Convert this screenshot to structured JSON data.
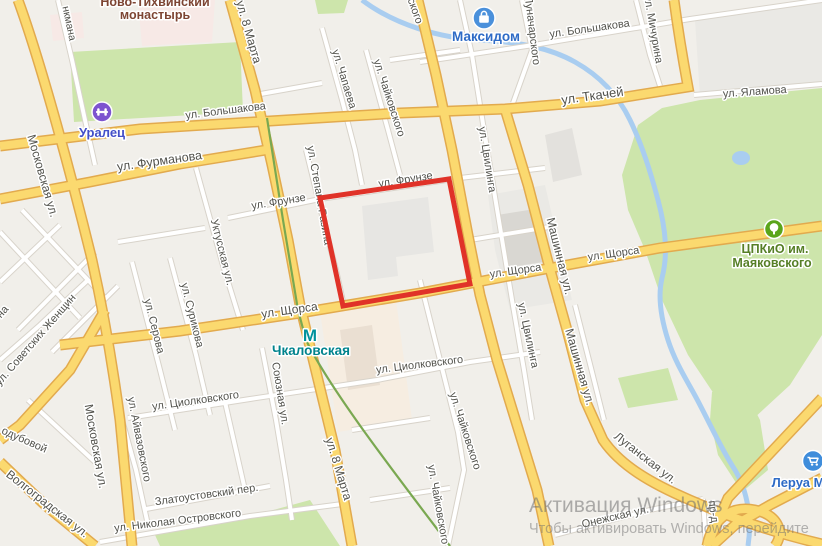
{
  "map": {
    "colors": {
      "land": "#f1efea",
      "green_area": "#cde5ab",
      "grey_area": "#eae9e5",
      "water": "#a9cdf0",
      "road_major_fill": "#fbd96f",
      "road_major_casing": "#e2aa4e",
      "road_minor_fill": "#ffffff",
      "road_minor_casing": "#d8d3ca",
      "tram_line": "#7aa851",
      "highlight_red": "#e03228",
      "street_text": "#52524c"
    },
    "street_labels": [
      {
        "t": "нкмана",
        "x": 66,
        "y": 24,
        "r": 78,
        "s": 10.5
      },
      {
        "t": "ул. 8 Марта",
        "x": 245,
        "y": 33,
        "r": 74,
        "s": 12
      },
      {
        "t": "ул. Большакова",
        "x": 226,
        "y": 114,
        "r": -7,
        "s": 11
      },
      {
        "t": "ул. Большакова",
        "x": 590,
        "y": 32,
        "r": -8,
        "s": 11
      },
      {
        "t": "ул. Мичурина",
        "x": 650,
        "y": 30,
        "r": 80,
        "s": 11
      },
      {
        "t": "ул. Ткачей",
        "x": 593,
        "y": 100,
        "r": -8,
        "s": 13
      },
      {
        "t": "ул. Яламова",
        "x": 755,
        "y": 95,
        "r": -4,
        "s": 11
      },
      {
        "t": "Луначарского",
        "x": 529,
        "y": 31,
        "r": 83,
        "s": 11
      },
      {
        "t": "ского",
        "x": 412,
        "y": 12,
        "r": 70,
        "s": 11
      },
      {
        "t": "ул. Чапаева",
        "x": 341,
        "y": 80,
        "r": 73,
        "s": 11
      },
      {
        "t": "ул. Чайковского",
        "x": 386,
        "y": 99,
        "r": 72,
        "s": 11
      },
      {
        "t": "ул. Фурманова",
        "x": 160,
        "y": 165,
        "r": -8,
        "s": 12.5
      },
      {
        "t": "Московская ул.",
        "x": 39,
        "y": 177,
        "r": 74,
        "s": 12
      },
      {
        "t": "Московская ул.",
        "x": 92,
        "y": 447,
        "r": 80,
        "s": 12
      },
      {
        "t": "ул. Фрунзе",
        "x": 279,
        "y": 205,
        "r": -9,
        "s": 11
      },
      {
        "t": "ул. Фрунзе",
        "x": 406,
        "y": 183,
        "r": -9,
        "s": 11
      },
      {
        "t": "ул. Степана Разина",
        "x": 316,
        "y": 196,
        "r": 80,
        "s": 11
      },
      {
        "t": "Уктусская ул.",
        "x": 219,
        "y": 253,
        "r": 76,
        "s": 11
      },
      {
        "t": "ул. Цвилинга",
        "x": 484,
        "y": 160,
        "r": 81,
        "s": 11
      },
      {
        "t": "ул. Цвилинга",
        "x": 525,
        "y": 336,
        "r": 78,
        "s": 11
      },
      {
        "t": "Машинная ул.",
        "x": 556,
        "y": 257,
        "r": 76,
        "s": 12
      },
      {
        "t": "Машинная ул.",
        "x": 576,
        "y": 368,
        "r": 74,
        "s": 12
      },
      {
        "t": "ул. Щорса",
        "x": 290,
        "y": 314,
        "r": -8,
        "s": 12
      },
      {
        "t": "ул. Щорса",
        "x": 516,
        "y": 274,
        "r": -8,
        "s": 11
      },
      {
        "t": "ул. Щорса",
        "x": 614,
        "y": 257,
        "r": -8,
        "s": 11
      },
      {
        "t": "ул. Серова",
        "x": 151,
        "y": 327,
        "r": 76,
        "s": 11
      },
      {
        "t": "ул. Сурикова",
        "x": 189,
        "y": 316,
        "r": 76,
        "s": 11
      },
      {
        "t": "ул. Советских Женщин",
        "x": 38,
        "y": 342,
        "r": -49,
        "s": 11
      },
      {
        "t": "на",
        "x": 5,
        "y": 314,
        "r": -49,
        "s": 11
      },
      {
        "t": "Союзная ул.",
        "x": 277,
        "y": 394,
        "r": 81,
        "s": 11
      },
      {
        "t": "ул. Циолковского",
        "x": 196,
        "y": 404,
        "r": -8,
        "s": 11
      },
      {
        "t": "ул. Циолковского",
        "x": 420,
        "y": 368,
        "r": -7,
        "s": 11
      },
      {
        "t": "ул. Чайковского",
        "x": 462,
        "y": 432,
        "r": 72,
        "s": 11
      },
      {
        "t": "ул. Чайковского",
        "x": 435,
        "y": 505,
        "r": 80,
        "s": 11
      },
      {
        "t": "ул. 8 Марта",
        "x": 335,
        "y": 470,
        "r": 73,
        "s": 12
      },
      {
        "t": "ул. Айвазовского",
        "x": 136,
        "y": 440,
        "r": 79,
        "s": 11
      },
      {
        "t": "Златоустовский пер.",
        "x": 207,
        "y": 498,
        "r": -8,
        "s": 11
      },
      {
        "t": "ул. Николая Островского",
        "x": 178,
        "y": 524,
        "r": -7,
        "s": 11
      },
      {
        "t": "Волгоградская ул.",
        "x": 45,
        "y": 507,
        "r": 38,
        "s": 12
      },
      {
        "t": "одубовой",
        "x": 23,
        "y": 443,
        "r": 24,
        "s": 11
      },
      {
        "t": "Луганская ул.",
        "x": 643,
        "y": 461,
        "r": 38,
        "s": 12
      },
      {
        "t": "Онежская ул.",
        "x": 616,
        "y": 520,
        "r": -13,
        "s": 11
      },
      {
        "t": "пр-д",
        "x": 710,
        "y": 512,
        "r": 82,
        "s": 11
      }
    ],
    "area_label": {
      "line1": "Ново-Тихвинский",
      "line2": "монастырь",
      "x": 155,
      "y1": 6,
      "y2": 19,
      "color": "#7d4533",
      "size": 12.5
    },
    "pois": [
      {
        "name": "uralets",
        "icon": "dumbbell-icon",
        "label": "Уралец",
        "ix": 102,
        "iy": 112,
        "ir": 10,
        "icolor": "#7d54cf",
        "lx": 102,
        "ly": 137,
        "lsize": 13,
        "lcolor": "#4450c8"
      },
      {
        "name": "maksidom",
        "icon": "shopping-bag-icon",
        "label": "Максидом",
        "ix": 484,
        "iy": 18,
        "ir": 11,
        "icolor": "#4a90db",
        "lx": 486,
        "ly": 41,
        "lsize": 13.5,
        "lcolor": "#2e6bc6"
      },
      {
        "name": "cpkio-mayakovskogo",
        "icon": "tree-icon",
        "label": "ЦПКиО им.",
        "label2": "Маяковского",
        "ix": 774,
        "iy": 229,
        "ir": 9.5,
        "icolor": "#5aa51b",
        "lx": 775,
        "ly": 253,
        "ly2": 267,
        "lsize": 12.5,
        "lcolor": "#567f26"
      },
      {
        "name": "lerua",
        "icon": "shopping-cart-icon",
        "label": "Леруа М",
        "ix": 813,
        "iy": 461,
        "ir": 10.5,
        "icolor": "#3f8ddb",
        "lx": 798,
        "ly": 487,
        "lsize": 13,
        "lcolor": "#2e6bc6"
      }
    ],
    "metro": {
      "name": "chkalovskaya",
      "icon": "metro-m-icon",
      "label": "Чкаловская",
      "ix": 310,
      "iy": 336,
      "icolor": "#00929c",
      "lx": 311,
      "ly": 351,
      "lsize": 13.5,
      "lcolor": "#00838d"
    },
    "watermark": {
      "line1": "Активация Windows",
      "line2": "Чтобы активировать Windows, перейдите"
    }
  }
}
